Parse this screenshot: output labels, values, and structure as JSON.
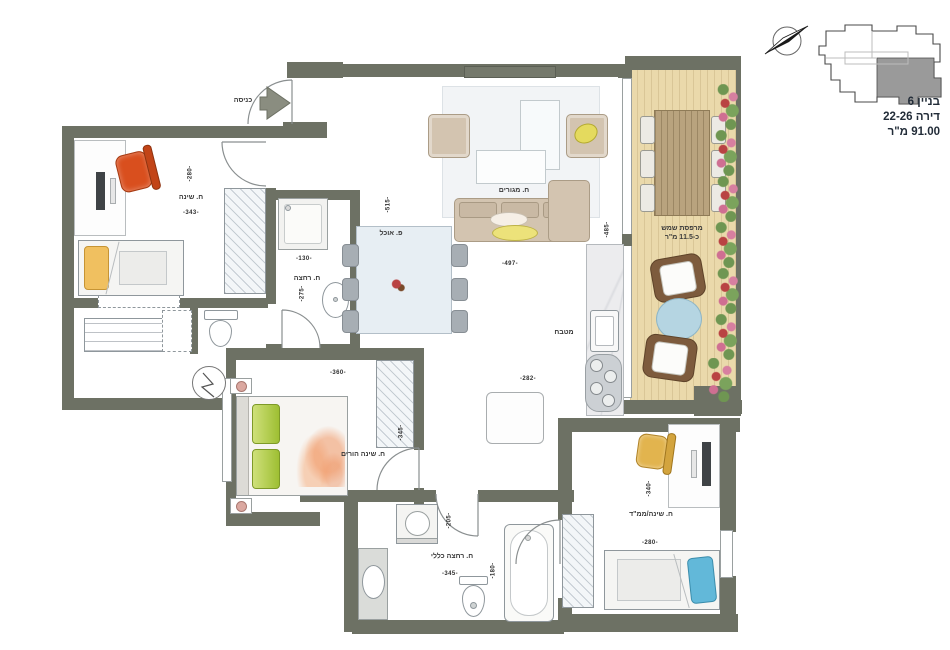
{
  "info": {
    "building": "בניין 6",
    "apartment": "דירה 22-26",
    "area": "91.00 מ\"ר"
  },
  "entrance": {
    "label": "כניסה"
  },
  "rooms": {
    "bedroom1": {
      "label": "ח. שינה",
      "dim_v": "-280-",
      "dim_h": "-343-"
    },
    "bathroom1": {
      "label": "ח. רחצה",
      "dim_h": "-130-",
      "dim_v": "-275-"
    },
    "dining": {
      "label": "פ. אוכל",
      "dim_v": "-515-"
    },
    "living": {
      "label": "ח. מגורים",
      "dim_w": "-497-",
      "dim_h": "-485-"
    },
    "kitchen": {
      "label": "מטבח",
      "dim_w": "-282-"
    },
    "balcony": {
      "label": "מרפסת שמש",
      "area": "כ-11.5 מ\"ר"
    },
    "master": {
      "label": "ח. שינה הורים",
      "dim_w": "-360-",
      "dim_h": "-345-"
    },
    "bathroom2": {
      "label": "ח. רחצה כללי",
      "dim_w": "-345-",
      "dim_v1": "-205-",
      "dim_v2": "-180-"
    },
    "mamad": {
      "label": "ח. שינה/ממ\"ד",
      "dim_w": "-280-",
      "dim_v": "-340-"
    }
  },
  "colors": {
    "wall": "#6d7164",
    "deck": "#ead9ab",
    "key_plan_shaded": "#9a9a9a",
    "accent_chair_orange": "#d94f1e",
    "accent_chair_yellow": "#e2b44e"
  }
}
